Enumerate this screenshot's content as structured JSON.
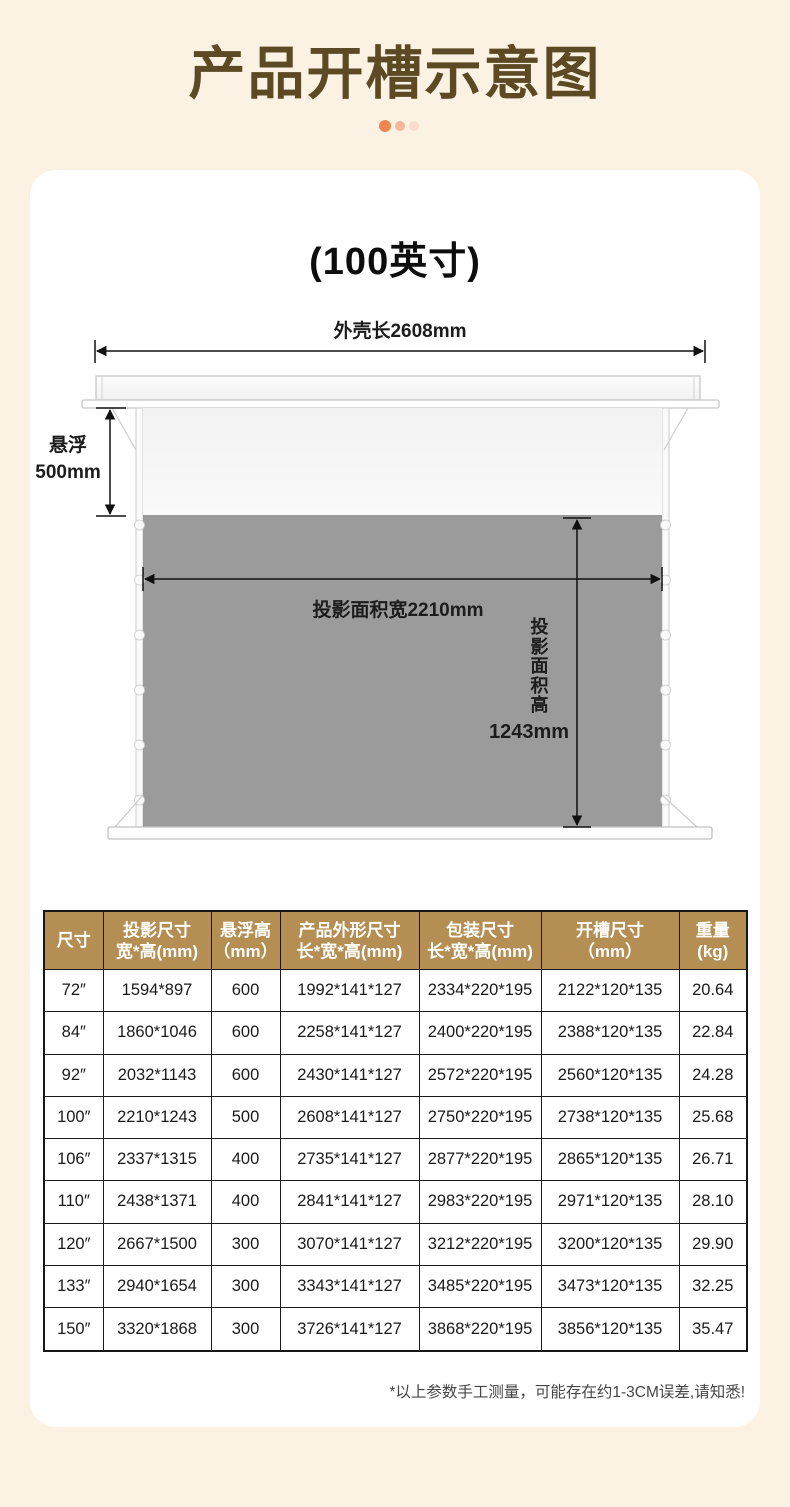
{
  "page": {
    "title": "产品开槽示意图",
    "carousel": {
      "dot_count": 3,
      "active_index": 0
    }
  },
  "colors": {
    "background": "#fcf2e3",
    "card": "#ffffff",
    "title": "#5b4a24",
    "dot1": "#f0854f",
    "dot2": "#f5b79c",
    "dot3": "#f9ddcb",
    "table_header_bg": "#b48e52",
    "table_border": "#171717",
    "text": "#1a1a1a",
    "note": "#454545",
    "screen_gray": "#9b9b9b"
  },
  "diagram": {
    "card_title": "(100英寸)",
    "shell_length_label": "外壳长2608mm",
    "float_label_line1": "悬浮",
    "float_label_line2": "500mm",
    "projection_width_label": "投影面积宽2210mm",
    "projection_height_label": "投影面积高",
    "projection_height_value": "1243mm"
  },
  "table": {
    "headers": [
      {
        "line1": "尺寸",
        "line2": ""
      },
      {
        "line1": "投影尺寸",
        "line2": "宽*高(mm)"
      },
      {
        "line1": "悬浮高",
        "line2": "（mm）"
      },
      {
        "line1": "产品外形尺寸",
        "line2": "长*宽*高(mm)"
      },
      {
        "line1": "包装尺寸",
        "line2": "长*宽*高(mm)"
      },
      {
        "line1": "开槽尺寸",
        "line2": "（mm）"
      },
      {
        "line1": "重量",
        "line2": "(kg)"
      }
    ],
    "rows": [
      [
        "72″",
        "1594*897",
        "600",
        "1992*141*127",
        "2334*220*195",
        "2122*120*135",
        "20.64"
      ],
      [
        "84″",
        "1860*1046",
        "600",
        "2258*141*127",
        "2400*220*195",
        "2388*120*135",
        "22.84"
      ],
      [
        "92″",
        "2032*1143",
        "600",
        "2430*141*127",
        "2572*220*195",
        "2560*120*135",
        "24.28"
      ],
      [
        "100″",
        "2210*1243",
        "500",
        "2608*141*127",
        "2750*220*195",
        "2738*120*135",
        "25.68"
      ],
      [
        "106″",
        "2337*1315",
        "400",
        "2735*141*127",
        "2877*220*195",
        "2865*120*135",
        "26.71"
      ],
      [
        "110″",
        "2438*1371",
        "400",
        "2841*141*127",
        "2983*220*195",
        "2971*120*135",
        "28.10"
      ],
      [
        "120″",
        "2667*1500",
        "300",
        "3070*141*127",
        "3212*220*195",
        "3200*120*135",
        "29.90"
      ],
      [
        "133″",
        "2940*1654",
        "300",
        "3343*141*127",
        "3485*220*195",
        "3473*120*135",
        "32.25"
      ],
      [
        "150″",
        "3320*1868",
        "300",
        "3726*141*127",
        "3868*220*195",
        "3856*120*135",
        "35.47"
      ]
    ]
  },
  "footnote": "*以上参数手工测量，可能存在约1-3CM误差,请知悉!"
}
